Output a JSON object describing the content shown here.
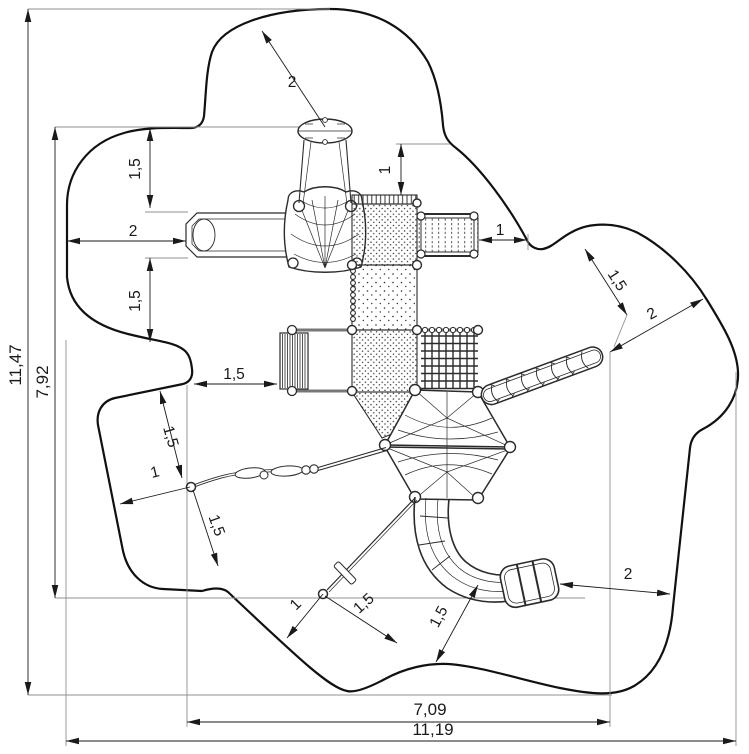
{
  "drawing": {
    "kind": "playground-equipment-safety-zone-plan",
    "background": "#ffffff",
    "line_color": "#1a1a1a",
    "extension_line_color": "#909090",
    "equipment": [
      "overhead-saucer-disc",
      "hanging-net-basket",
      "crawl-tunnel",
      "dotted-platform-upper",
      "bridge-ramp",
      "vertical-ladder",
      "climbing-net-grid",
      "dotted-platform-mid",
      "dotted-platform-lower",
      "double-membrane-climber",
      "diagonal-rung-ladder",
      "curved-tube-slide",
      "balance-rope-with-grips",
      "guy-rope-turnbuckle",
      "ground-anchor-left",
      "ground-anchor-right"
    ]
  },
  "dimensions": [
    {
      "id": "clearance-top-leader",
      "label": "2"
    },
    {
      "id": "clearance-top-left-vertical",
      "label": "1,5"
    },
    {
      "id": "tunnel-to-boundary-left",
      "label": "2"
    },
    {
      "id": "clearance-mid-left-vertical",
      "label": "1,5"
    },
    {
      "id": "ladder-to-boundary-left",
      "label": "1,5"
    },
    {
      "id": "clearance-top-right-vertical",
      "label": "1"
    },
    {
      "id": "bridge-to-boundary-right",
      "label": "1"
    },
    {
      "id": "clearance-upper-right-diagonal",
      "label": "1,5"
    },
    {
      "id": "ladder-end-to-boundary-diagonal",
      "label": "2"
    },
    {
      "id": "rope-anchor-to-top-edge",
      "label": "1,5"
    },
    {
      "id": "rope-anchor-to-left-edge",
      "label": "1"
    },
    {
      "id": "rope-anchor-to-bottom-edge",
      "label": "1,5"
    },
    {
      "id": "ground-anchor-to-left-edge",
      "label": "1"
    },
    {
      "id": "ground-anchor-to-right-edge",
      "label": "1,5"
    },
    {
      "id": "slide-exit-to-bottom-edge",
      "label": "1,5"
    },
    {
      "id": "slide-exit-to-right-boundary",
      "label": "2"
    },
    {
      "id": "inner-width",
      "label": "7,09"
    },
    {
      "id": "total-width",
      "label": "11,19"
    },
    {
      "id": "total-height",
      "label": "11,47"
    },
    {
      "id": "inner-height",
      "label": "7,92"
    }
  ]
}
